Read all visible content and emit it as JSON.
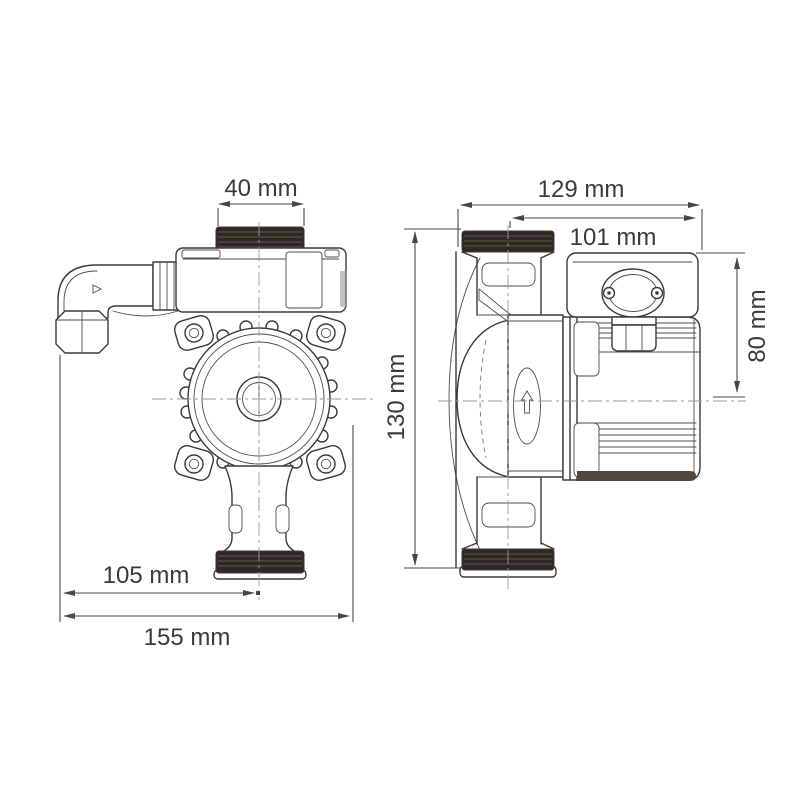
{
  "diagram": {
    "background": "#ffffff",
    "line_color": "#3a3a3a",
    "thread_color": "#2d2823",
    "text_color": "#3a3a3a",
    "views": [
      {
        "id": "front",
        "description": "pump front view with elbow fitting"
      },
      {
        "id": "side",
        "description": "pump side view with motor and terminal box"
      }
    ],
    "dimensions": {
      "top_port_thread": {
        "label": "40 mm",
        "orientation": "horizontal"
      },
      "overall_depth": {
        "label": "129 mm",
        "orientation": "horizontal"
      },
      "motor_assembly_depth": {
        "label": "101 mm",
        "orientation": "horizontal"
      },
      "motor_height": {
        "label": "80 mm",
        "orientation": "vertical"
      },
      "overall_height": {
        "label": "130 mm",
        "orientation": "vertical"
      },
      "pump_center_offset": {
        "label": "105 mm",
        "orientation": "horizontal"
      },
      "overall_width": {
        "label": "155 mm",
        "orientation": "horizontal"
      }
    }
  }
}
